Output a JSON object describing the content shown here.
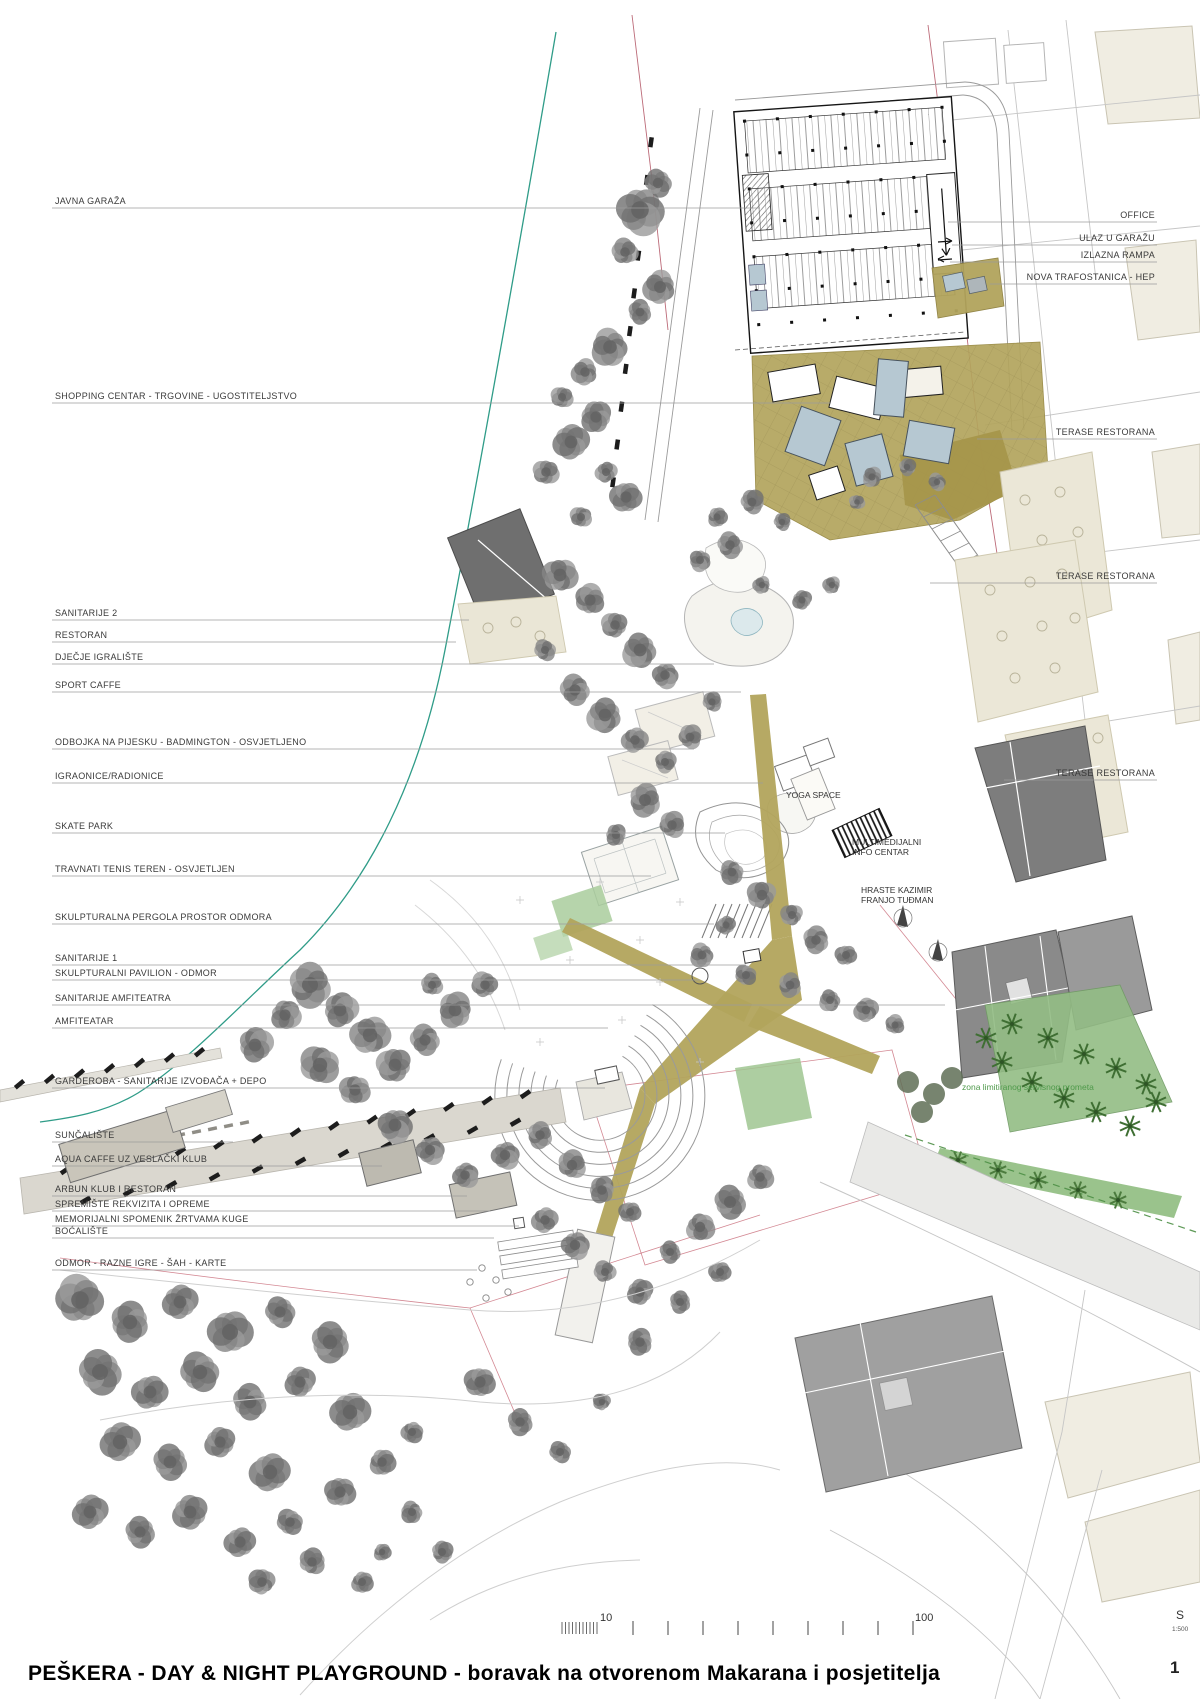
{
  "title_block": {
    "title": "PEŠKERA -  DAY & NIGHT PLAYGROUND - boravak na otvorenom Makarana i posjetitelja",
    "page_number": "1"
  },
  "scale_bar": {
    "tick_label_10": "10",
    "tick_label_100": "100",
    "north_letter": "S",
    "scale_ratio": "1:500"
  },
  "colors": {
    "paper": "#ffffff",
    "coast_line": "#2f9c88",
    "boundary_red": "#b05060",
    "khaki_zone": "#b2a45c",
    "roof_blue": "#b6c8d2",
    "terrace_beige": "#ebe7d7",
    "building_gray": "#7d7d7d",
    "tree_gray": "#8a8a8a",
    "green_area": "#93bd85",
    "palm_green": "#3f6f33",
    "label_text": "#3a3a3a"
  },
  "left_labels": [
    {
      "text": "JAVNA GARAŽA",
      "y": 205,
      "end": 760
    },
    {
      "text": "SHOPPING CENTAR - TRGOVINE - UGOSTITELJSTVO",
      "y": 400,
      "end": 830
    },
    {
      "text": "SANITARIJE 2",
      "y": 617,
      "end": 469
    },
    {
      "text": "RESTORAN",
      "y": 639,
      "end": 456
    },
    {
      "text": "DJEČJE IGRALIŠTE",
      "y": 661,
      "end": 714
    },
    {
      "text": "SPORT CAFFE",
      "y": 689,
      "end": 741
    },
    {
      "text": "ODBOJKA NA PIJESKU - BADMINGTON - OSVJETLJENO",
      "y": 746,
      "end": 694
    },
    {
      "text": "IGRAONICE/RADIONICE",
      "y": 780,
      "end": 763
    },
    {
      "text": "SKATE PARK",
      "y": 830,
      "end": 725
    },
    {
      "text": "TRAVNATI TENIS TEREN  -  OSVJETLJEN",
      "y": 873,
      "end": 651
    },
    {
      "text": "SKULPTURALNA PERGOLA PROSTOR ODMORA",
      "y": 921,
      "end": 714
    },
    {
      "text": "SANITARIJE 1",
      "y": 962,
      "end": 746
    },
    {
      "text": "SKULPTURALNI PAVILION - ODMOR",
      "y": 977,
      "end": 700
    },
    {
      "text": "SANITARIJE AMFITEATRA",
      "y": 1002,
      "end": 945
    },
    {
      "text": "AMFITEATAR",
      "y": 1025,
      "end": 608
    },
    {
      "text": "GARDEROBA - SANITARIJE IZVOĐAČA + DEPO",
      "y": 1085,
      "end": 605
    },
    {
      "text": "SUNČALIŠTE",
      "y": 1139,
      "end": 233
    },
    {
      "text": "AQUA CAFFE UZ VESLAČKI KLUB",
      "y": 1163,
      "end": 382
    },
    {
      "text": "ARBUN KLUB I RESTORAN",
      "y": 1193,
      "end": 467
    },
    {
      "text": "SPREMIŠTE REKVIZITA I OPREME",
      "y": 1208,
      "end": 490
    },
    {
      "text": "MEMORIJALNI SPOMENIK ŽRTVAMA KUGE",
      "y": 1223,
      "end": 519
    },
    {
      "text": "BOĆALIŠTE",
      "y": 1235,
      "end": 494
    },
    {
      "text": "ODMOR - RAZNE IGRE - ŠAH - KARTE",
      "y": 1267,
      "end": 477
    }
  ],
  "right_labels": [
    {
      "text": "OFFICE",
      "y": 219,
      "start": 948
    },
    {
      "text": "ULAZ U GARAŽU",
      "y": 242,
      "start": 952
    },
    {
      "text": "IZLAZNA RAMPA",
      "y": 259,
      "start": 950
    },
    {
      "text": "NOVA TRAFOSTANICA - HEP",
      "y": 281,
      "start": 990
    },
    {
      "text": "TERASE RESTORANA",
      "y": 436,
      "start": 977
    },
    {
      "text": "TERASE RESTORANA",
      "y": 580,
      "start": 930
    },
    {
      "text": "TERASE RESTORANA",
      "y": 777,
      "start": 1004
    }
  ],
  "map_labels": [
    {
      "text": "YOGA SPACE",
      "x": 786,
      "y": 798,
      "green": false
    },
    {
      "text": "MULTIMEDIJALNI",
      "line2": "INFO CENTAR",
      "x": 852,
      "y": 845,
      "green": false
    },
    {
      "text": "HRASTE  KAZIMIR",
      "line2": "FRANJO TUĐMAN",
      "x": 861,
      "y": 893,
      "green": false
    },
    {
      "text": "zona limitiranog servisnog prometa",
      "x": 962,
      "y": 1090,
      "green": true
    }
  ]
}
